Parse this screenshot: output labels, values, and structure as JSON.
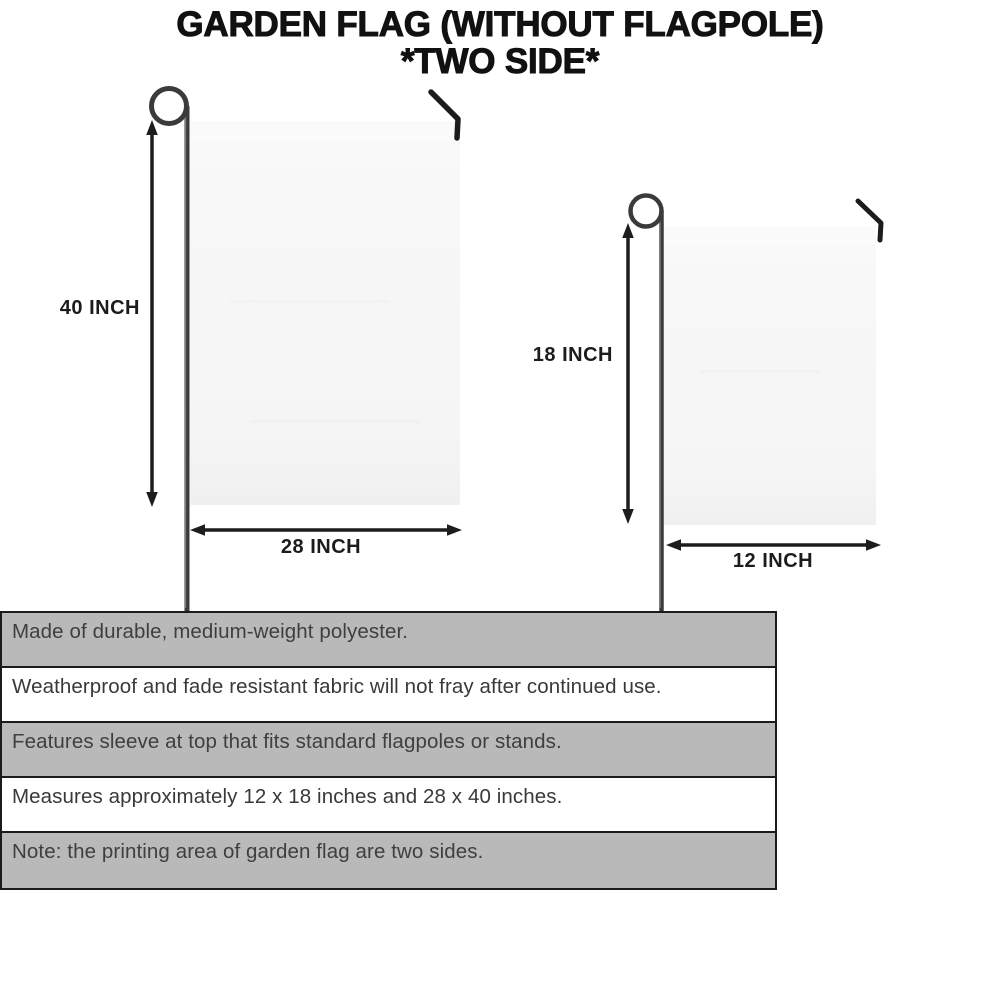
{
  "title": {
    "line1": "GARDEN FLAG (WITHOUT FLAGPOLE)",
    "line2": "*TWO SIDE*"
  },
  "diagram": {
    "large_flag": {
      "name": "large garden flag on stand",
      "height_label": "40 INCH",
      "width_label": "28 INCH"
    },
    "small_flag": {
      "name": "small garden flag on stand",
      "height_label": "18 INCH",
      "width_label": "12 INCH"
    }
  },
  "specs": {
    "rows": [
      {
        "text": "Made of durable, medium-weight polyester."
      },
      {
        "text": "Weatherproof and fade resistant fabric will not fray after continued use."
      },
      {
        "text": "Features sleeve at top that fits standard flagpoles or stands."
      },
      {
        "text": "Measures approximately 12 x 18 inches and 28 x 40 inches."
      },
      {
        "text": "Note: the printing area of garden flag are two sides."
      }
    ]
  },
  "colors": {
    "background": "#ffffff",
    "title_text": "#111111",
    "flag_fill": "#f7f7f7",
    "pole": "#3b3b3b",
    "arrow": "#1d1d1d",
    "band_gray": "#b9b9b9",
    "band_border": "#1b1b1b",
    "spec_text": "#3f3f3f"
  }
}
